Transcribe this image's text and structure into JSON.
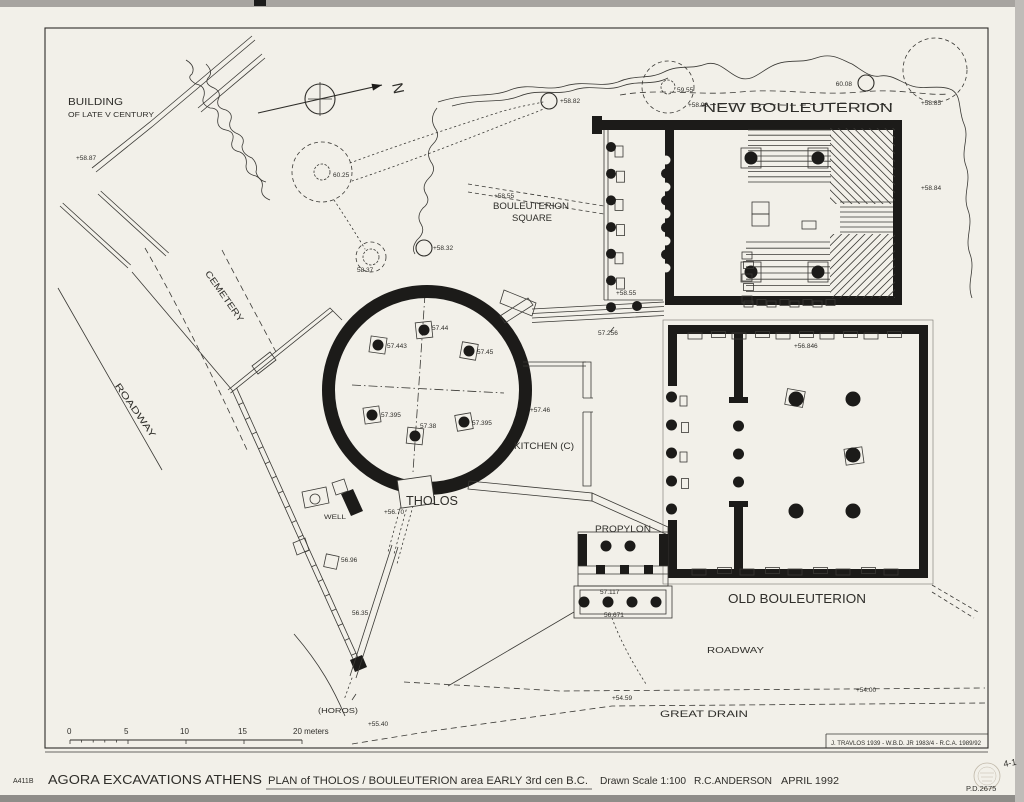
{
  "page": {
    "sheet_code": "A411B",
    "pd_number": "P.D.2675",
    "sheet_note": "4-1"
  },
  "caption": {
    "title": "AGORA  EXCAVATIONS  ATHENS",
    "subtitle": "PLAN of THOLOS / BOULEUTERION area  EARLY 3rd cen B.C.",
    "scale_note": "Drawn Scale 1:100",
    "author": "R.C.ANDERSON",
    "date": "APRIL 1992"
  },
  "credits": "J. TRAVLOS 1939 - W.B.D. JR 1983/4 - R.C.A. 1989/92",
  "labels": {
    "building_l1": "BUILDING",
    "building_l2": "OF LATE V CENTURY",
    "cemetery": "CEMETERY",
    "roadway_west": "ROADWAY",
    "roadway_south": "ROADWAY",
    "square_l1": "BOULEUTERION",
    "square_l2": "SQUARE",
    "new_bouleuterion": "NEW  BOULEUTERION",
    "old_bouleuterion": "OLD  BOULEUTERION",
    "tholos": "THOLOS",
    "kitchen": "KITCHEN (C)",
    "propylon": "PROPYLON",
    "well": "WELL",
    "horos": "(HOROS)",
    "great_drain": "GREAT  DRAIN",
    "north": "N"
  },
  "scalebar": {
    "labels": [
      "0",
      "5",
      "10",
      "15",
      "20 meters"
    ]
  },
  "elevations": [
    {
      "v": "+58.87"
    },
    {
      "v": "60.25"
    },
    {
      "v": "+58.82"
    },
    {
      "v": "59.55"
    },
    {
      "v": "60.08"
    },
    {
      "v": "+58.90"
    },
    {
      "v": "+58.85"
    },
    {
      "v": "+58.84"
    },
    {
      "v": "+58.55"
    },
    {
      "v": "58.37"
    },
    {
      "v": "+58.32"
    },
    {
      "v": "+58.55"
    },
    {
      "v": "57.256"
    },
    {
      "v": "+56.846"
    },
    {
      "v": "57.443"
    },
    {
      "v": "57.44"
    },
    {
      "v": "57.45"
    },
    {
      "v": "57.395"
    },
    {
      "v": "57.38"
    },
    {
      "v": "57.395"
    },
    {
      "v": "+57.46"
    },
    {
      "v": "+56.70"
    },
    {
      "v": "56.96"
    },
    {
      "v": "56.35"
    },
    {
      "v": "57.117"
    },
    {
      "v": "56.671"
    },
    {
      "v": "+55.40"
    },
    {
      "v": "+54.59"
    },
    {
      "v": "+54.00"
    }
  ],
  "colors": {
    "paper": "#f2f0e9",
    "ink": "#2f2e2a",
    "wall": "#1c1b19"
  }
}
